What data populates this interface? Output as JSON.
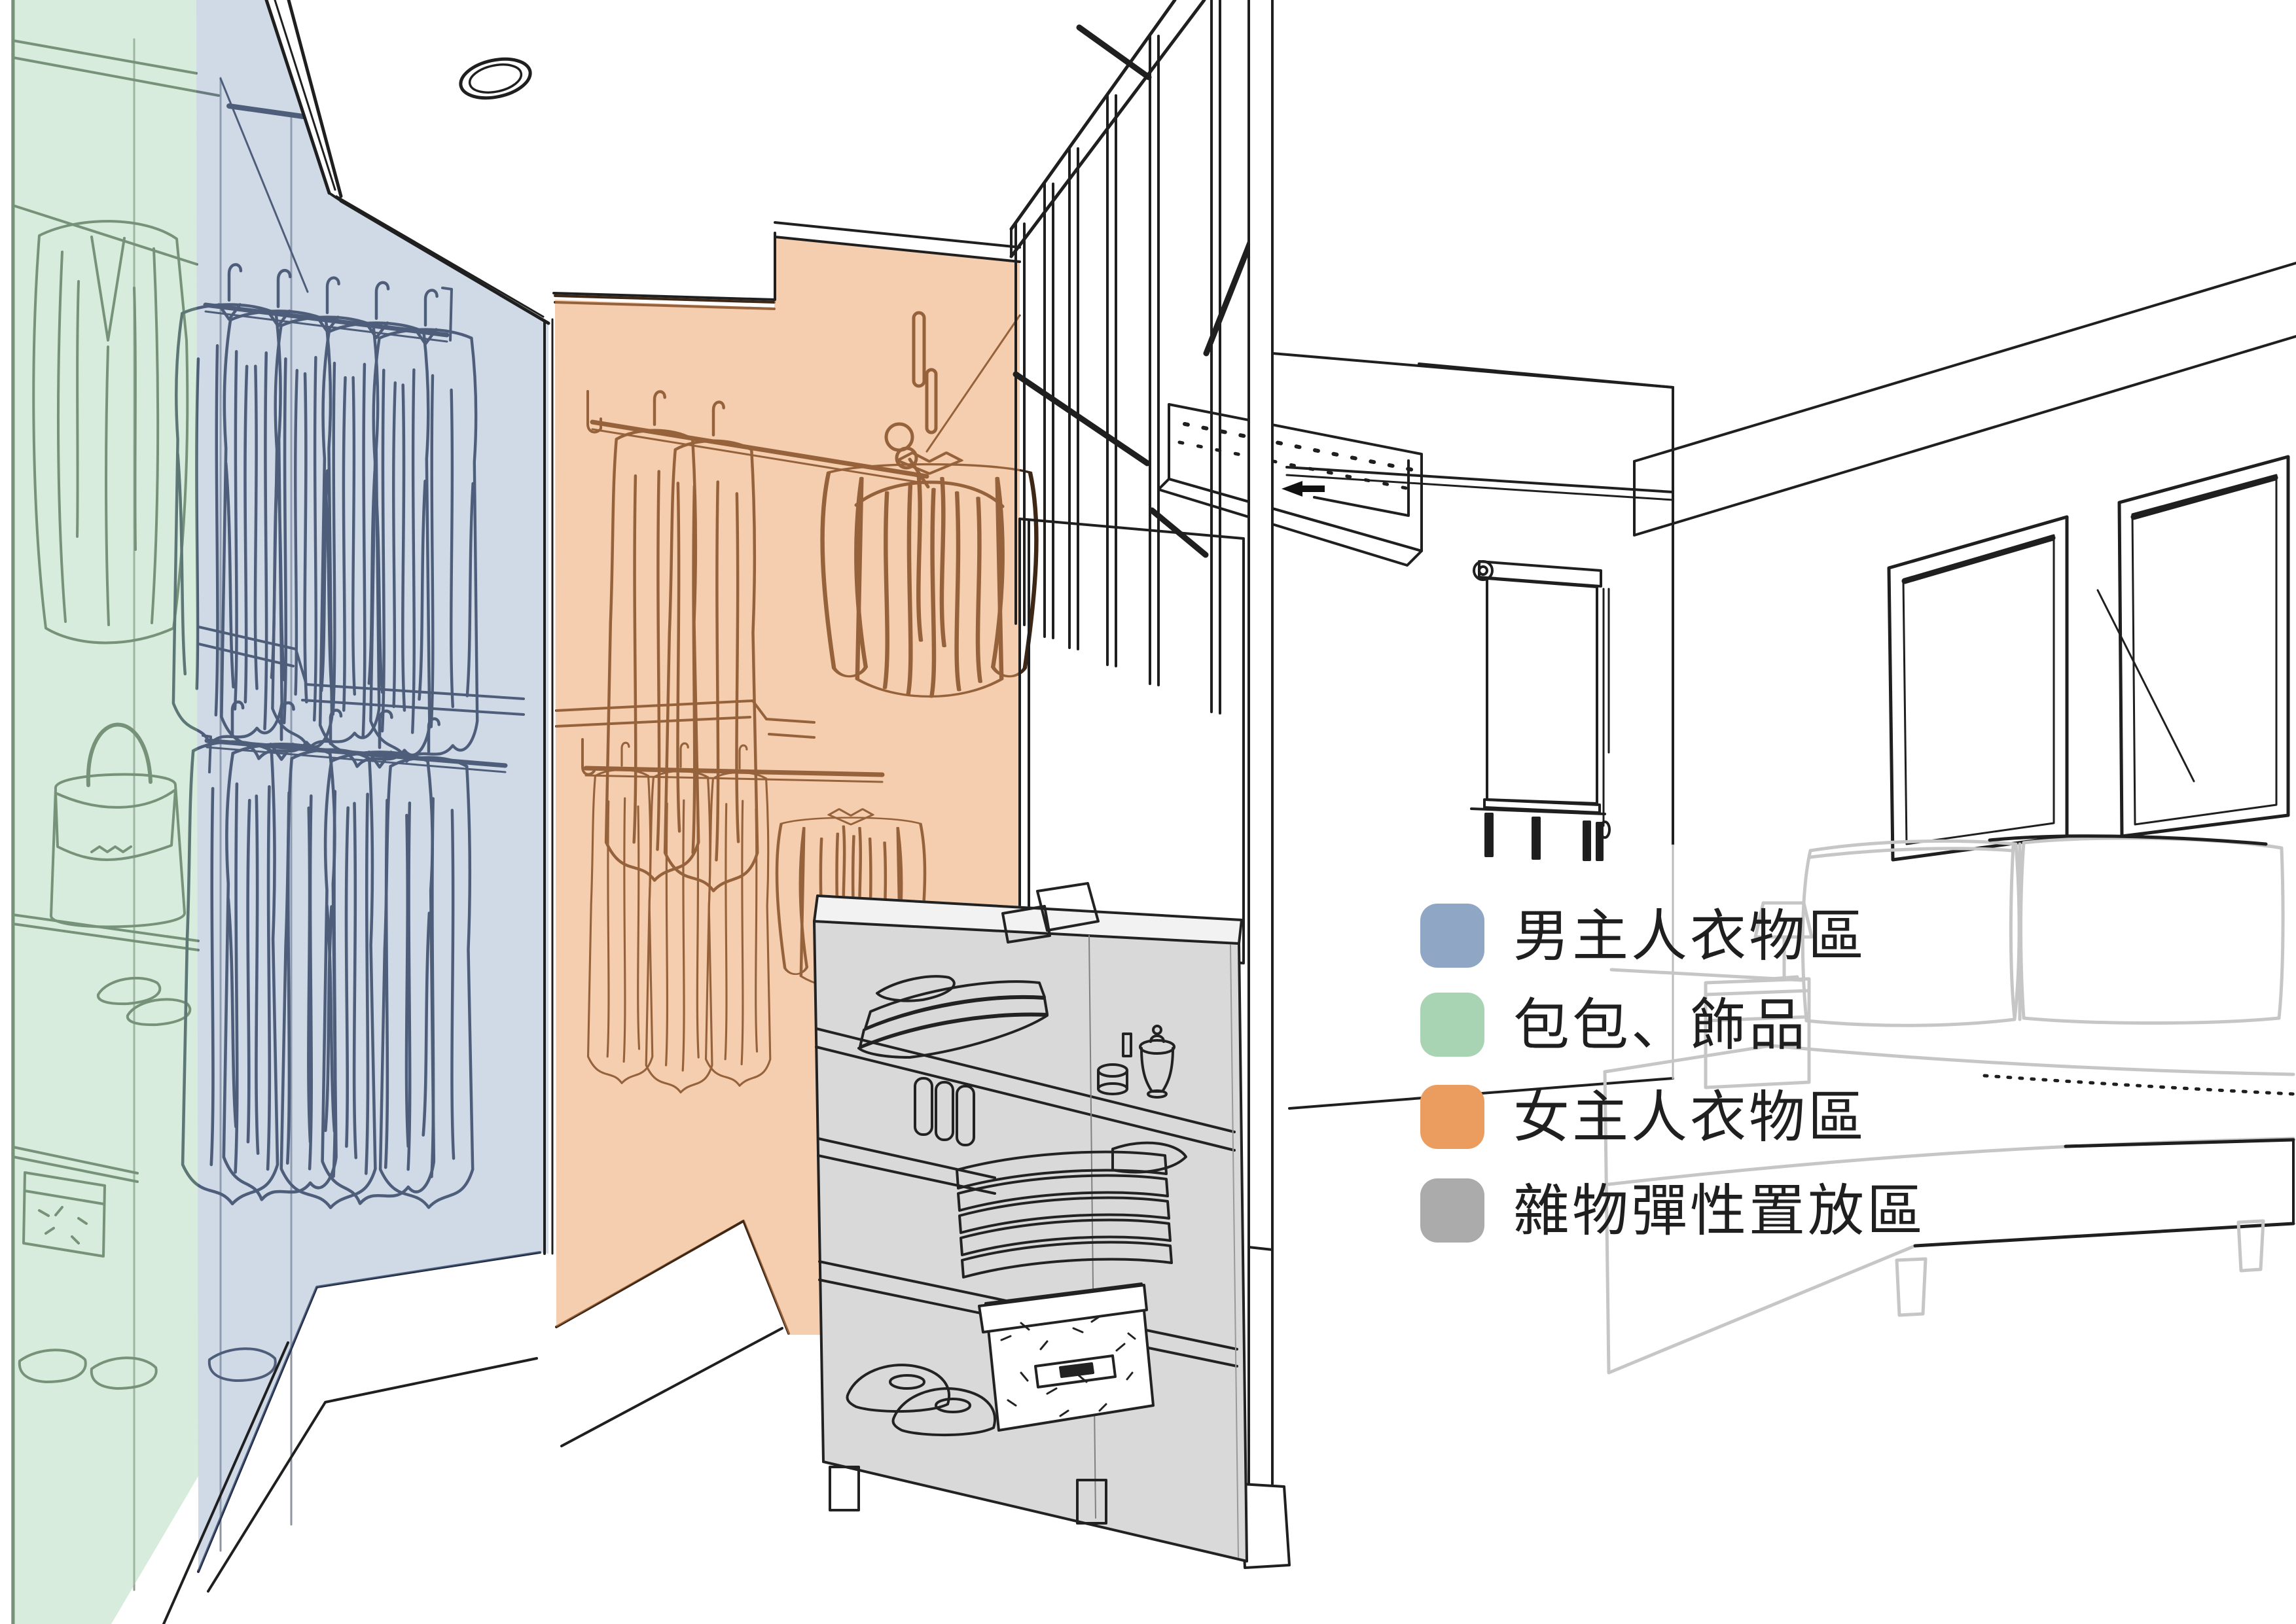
{
  "diagram": {
    "kind": "interior-zoning-perspective-sketch",
    "rooms": [
      "walk-in-closet",
      "bedroom"
    ]
  },
  "legend": {
    "items": [
      {
        "zone": "master-male-clothing",
        "label": "男主人衣物區",
        "color": "#8FA7C5"
      },
      {
        "zone": "bags-accessories",
        "label": "包包、飾品",
        "color": "#A9D4B4"
      },
      {
        "zone": "master-female-clothing",
        "label": "女主人衣物區",
        "color": "#EB9D60"
      },
      {
        "zone": "misc-flexible-storage",
        "label": "雜物彈性置放區",
        "color": "#ABABAB"
      }
    ]
  },
  "zones": [
    {
      "name": "male-clothing-overlay",
      "color": "#8FA7C5"
    },
    {
      "name": "bags-accessories-overlay",
      "color": "#A9D4B4"
    },
    {
      "name": "female-clothing-overlay",
      "color": "#EB9D60"
    },
    {
      "name": "misc-storage-island",
      "color": "#ABABAB"
    }
  ]
}
